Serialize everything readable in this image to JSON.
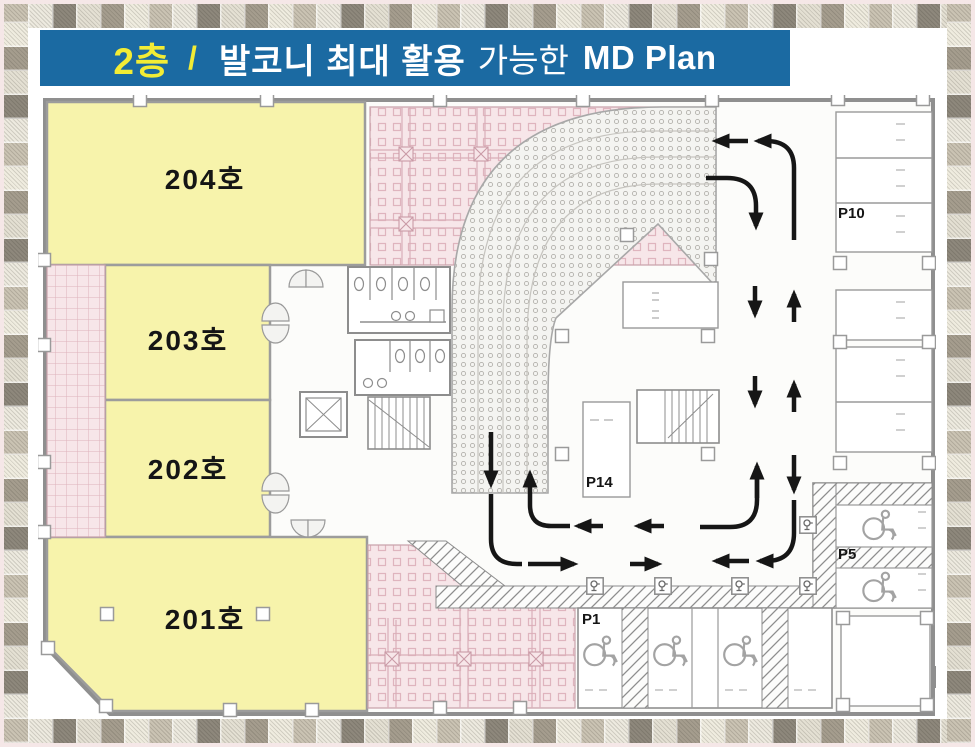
{
  "header": {
    "floor": "2층",
    "separator": "/",
    "title_emphasis": "발코니 최대 활용",
    "title_normal": "가능한",
    "title_en": "MD Plan"
  },
  "rooms": [
    {
      "label": "204호"
    },
    {
      "label": "203호"
    },
    {
      "label": "202호"
    },
    {
      "label": "201호"
    }
  ],
  "parking": [
    {
      "label": "P10"
    },
    {
      "label": "P14"
    },
    {
      "label": "P5"
    },
    {
      "label": "P1"
    }
  ],
  "colors": {
    "header_bg": "#1b6aa2",
    "header_floor_text": "#f2ec35",
    "header_text": "#ffffff",
    "room_fill": "#f7f3ab",
    "plaza_fill": "#f7e6e9",
    "promenade_dot": "#b3b1ac",
    "wall": "#8f8f8f",
    "arrow": "#161616",
    "frame_tile_light": "#edeadf",
    "frame_tile_dark": "#8e887c"
  }
}
